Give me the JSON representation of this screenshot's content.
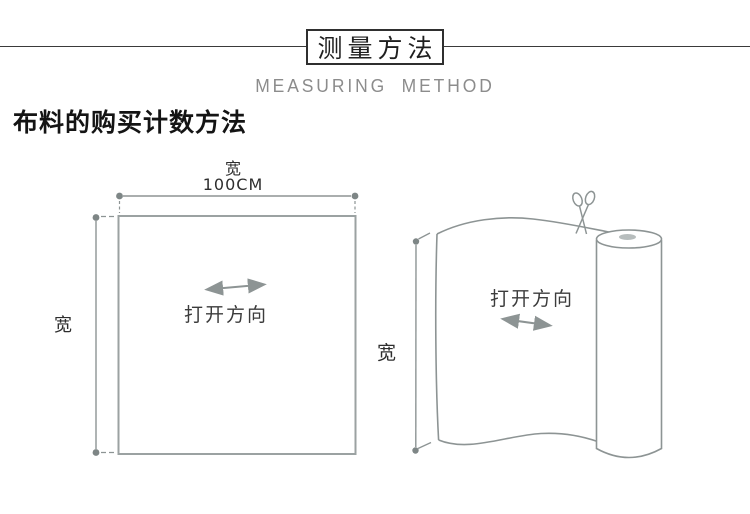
{
  "header": {
    "title": "测量方法",
    "subtitle": "MEASURING METHOD"
  },
  "section": {
    "heading": "布料的购买计数方法"
  },
  "left_diagram": {
    "top_width_label": "宽",
    "top_width_value": "100CM",
    "side_width_label": "宽",
    "open_direction_label": "打开方向"
  },
  "right_diagram": {
    "side_width_label": "宽",
    "open_direction_label": "打开方向"
  },
  "icons": {
    "left_open_direction_arrow": "horizontal-double-arrow",
    "right_open_direction_arrow": "diagonal-double-arrow",
    "cut_marker": "scissors-icon"
  },
  "colors": {
    "background": "#ffffff",
    "header_rule": "#3a3a3a",
    "title_border": "#2f2f2f",
    "subtitle_gray": "#8c8c8c",
    "diagram_line": "#8d9494",
    "square_border": "#9ba2a2",
    "dimension_dot": "#7e8686",
    "text_dark": "#2e2e2e",
    "roll_core": "#b7bdbd"
  }
}
